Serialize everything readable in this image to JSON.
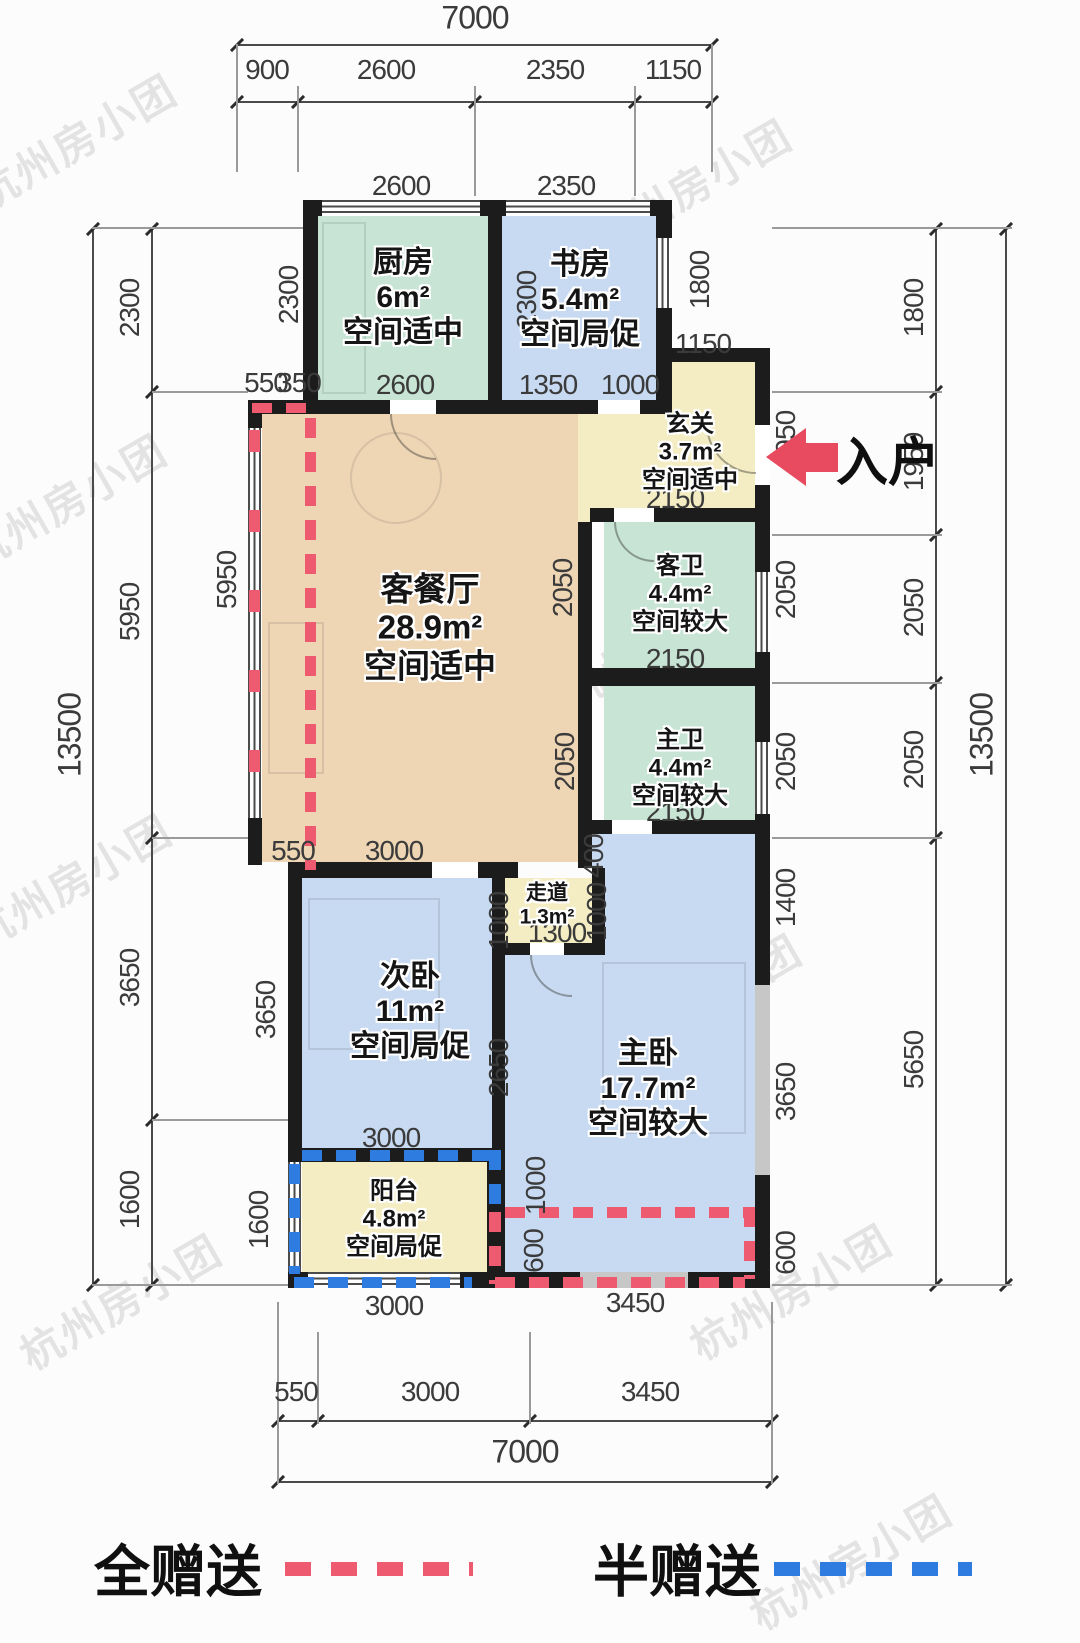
{
  "watermark": {
    "text": "杭州房小团"
  },
  "entry_arrow": {
    "label": "入户"
  },
  "legend": {
    "full_gift": "全赠送",
    "half_gift": "半赠送",
    "full_gift_color": "#ee5a70",
    "half_gift_color": "#2e7ce0"
  },
  "colors": {
    "wall": "#1c1c1c",
    "kitchen_bath_fill": "#c7e4d4",
    "bedroom_fill": "#c8daf1",
    "living_fill": "#eed5b4",
    "entry_fill": "#f4edc4",
    "window_gray": "#c7c7c7",
    "dim_text": "#3b3b3b",
    "arrow_red": "#e84a5f"
  },
  "rooms": {
    "kitchen": {
      "name": "厨房",
      "area": "6m²",
      "note": "空间适中"
    },
    "study": {
      "name": "书房",
      "area": "5.4m²",
      "note": "空间局促"
    },
    "entry": {
      "name": "玄关",
      "area": "3.7m²",
      "note": "空间适中"
    },
    "living": {
      "name": "客餐厅",
      "area": "28.9m²",
      "note": "空间适中"
    },
    "guest_bath": {
      "name": "客卫",
      "area": "4.4m²",
      "note": "空间较大"
    },
    "master_bath": {
      "name": "主卫",
      "area": "4.4m²",
      "note": "空间较大"
    },
    "corridor": {
      "name": "走道",
      "area": "1.3m²"
    },
    "second_bedroom": {
      "name": "次卧",
      "area": "11m²",
      "note": "空间局促"
    },
    "master_bedroom": {
      "name": "主卧",
      "area": "17.7m²",
      "note": "空间较大"
    },
    "balcony": {
      "name": "阳台",
      "area": "4.8m²",
      "note": "空间局促"
    }
  },
  "dims": {
    "top_total": "7000",
    "top_segments": [
      "900",
      "2600",
      "2350",
      "1150"
    ],
    "left_total": "13500",
    "left_segments": [
      "2300",
      "5950",
      "3650",
      "1600"
    ],
    "right_total": "13500",
    "right_segments": [
      "1800",
      "1950",
      "2050",
      "2050",
      "5650"
    ],
    "bottom_total": "7000",
    "bottom_segments": [
      "550",
      "3000",
      "3450"
    ],
    "inner": {
      "kitchen_top": "2600",
      "study_top": "2350",
      "kitchen_left": "2300",
      "study_left": "2300",
      "study_right": "1800",
      "study_step": "1150",
      "bay_a": "550",
      "bay_b": "350",
      "kitchen_bottom": "2600",
      "study_bottom_a": "1350",
      "study_bottom_b": "1000",
      "entry_bottom": "2150",
      "entry_right": "1950",
      "living_right_upper": "2050",
      "living_right_lower": "2050",
      "gbath_right": "2050",
      "mbath_right": "2050",
      "gbath_bottom": "2150",
      "mbath_bottom": "2150",
      "living_bottom_a": "550",
      "living_bottom_b": "3000",
      "corridor_top": "400",
      "corridor_left": "1000",
      "corridor_right": "1000",
      "corridor_bottom": "1300",
      "living_left": "5950",
      "sbed_left": "3650",
      "sbed_right": "2650",
      "sbed_bottom": "3000",
      "mbed_right_top": "1400",
      "mbed_right": "3650",
      "mbed_left_a": "1000",
      "mbed_left_b": "600",
      "balcony_left": "1600",
      "bottom_right": "600",
      "balcony_bottom": "3000",
      "mbed_bottom": "3450"
    }
  }
}
